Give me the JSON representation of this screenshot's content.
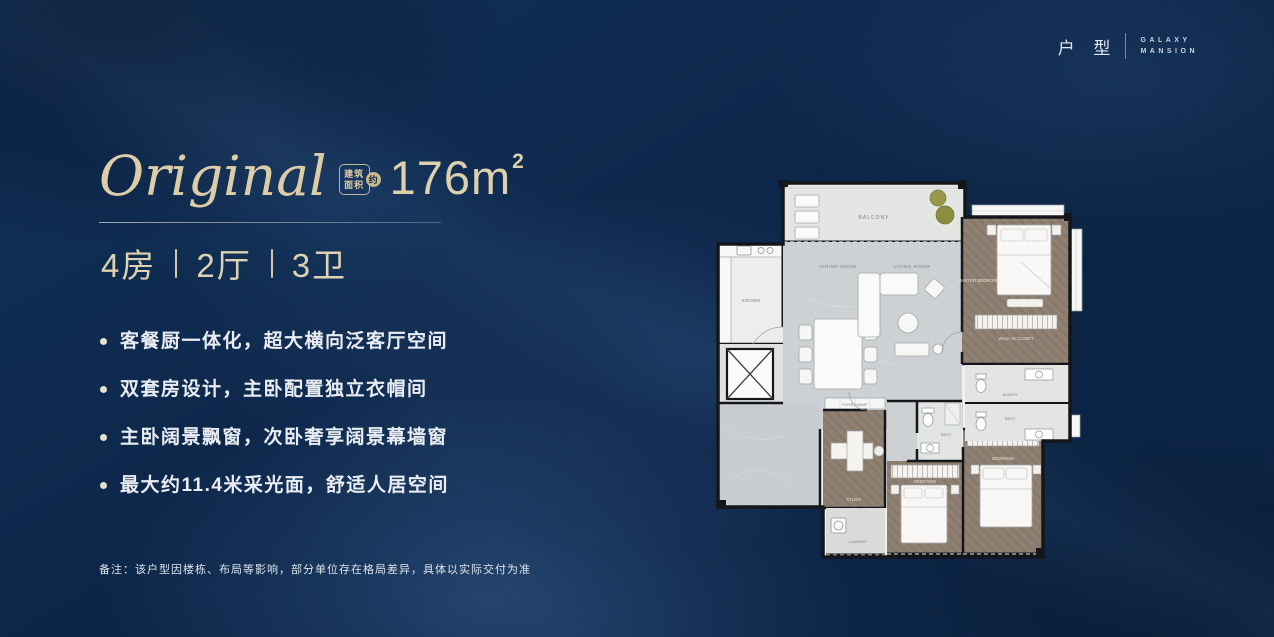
{
  "brand": {
    "cn": "户 型",
    "en1": "GALAXY",
    "en2": "MANSION"
  },
  "headline": {
    "script": "Original",
    "badge_top": "建筑",
    "badge_bottom": "面积",
    "badge_seal": "约",
    "area_number": "176",
    "area_unit": "m",
    "area_sup": "2"
  },
  "spec": {
    "items": [
      "4房",
      "2厅",
      "3卫"
    ]
  },
  "features": [
    "客餐厨一体化，超大横向泛客厅空间",
    "双套房设计，主卧配置独立衣帽间",
    "主卧阔景飘窗，次卧奢享阔景幕墙窗",
    "最大约11.4米采光面，舒适人居空间"
  ],
  "note": "备注：该户型因楼栋、布局等影响，部分单位存在格局差异，具体以实际交付为准",
  "colors": {
    "accent_cream": "#dccda8",
    "background_navy": "#0d2849",
    "floor_wood": "#8e7e70",
    "floor_marble": "#cdd1d3"
  },
  "floorplan": {
    "labels": {
      "balcony": "BALCONY",
      "kitchen": "KITCHEN",
      "dining": "DINING ROOM",
      "living": "LIVING ROOM",
      "master": "MASTER BEDROOM",
      "closet": "WALK-IN CLOSET",
      "mbath": "M.BATH",
      "bath": "BATH",
      "bath_mid": "BATH",
      "study": "STUDY",
      "laundry": "LAUNDRY",
      "bedroom2": "BEDROOM",
      "bedroom3": "BEDROOM",
      "cabinet": "FOYER CABINET"
    }
  }
}
